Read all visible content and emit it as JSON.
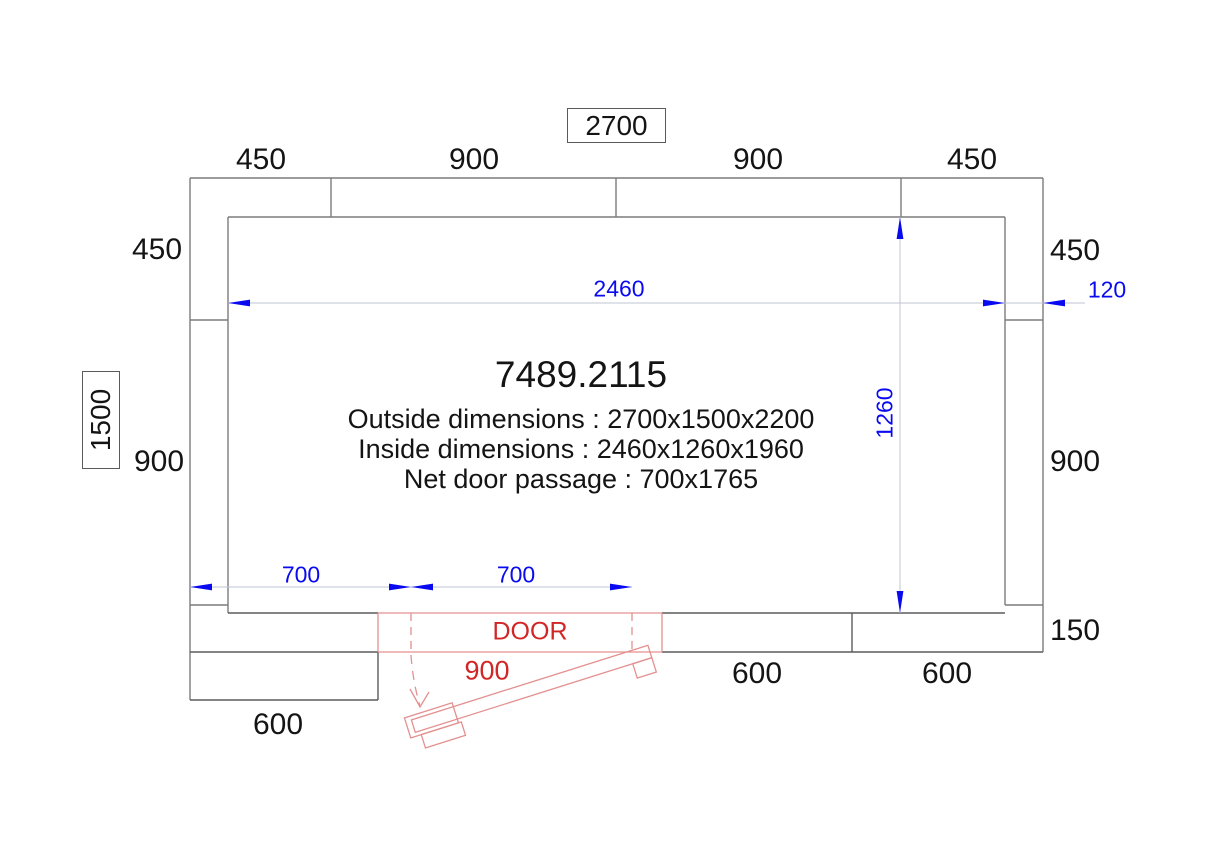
{
  "title_block": {
    "product_code": "7489.2115",
    "outside_dimensions": "Outside dimensions : 2700x1500x2200",
    "inside_dimensions": "Inside dimensions :  2460x1260x1960",
    "net_door_passage": "Net door passage : 700x1765"
  },
  "overall": {
    "width_label": "2700",
    "depth_label": "1500"
  },
  "top_segments": [
    "450",
    "900",
    "900",
    "450"
  ],
  "left_segments": [
    "450",
    "900"
  ],
  "right_segments": [
    "450",
    "900",
    "150"
  ],
  "bottom_segments": [
    "600",
    "600"
  ],
  "bottom_left_panel": "600",
  "inner": {
    "width": "2460",
    "depth": "1260",
    "wall_thickness": "120"
  },
  "door": {
    "label": "DOOR",
    "width": "900",
    "offset_left": "700",
    "passage": "700"
  },
  "colors": {
    "wall_line": "#7c7c7c",
    "panel_line": "#5c5c5c",
    "dimension_blue": "#0a0af0",
    "dimension_line": "#c2c6d6",
    "door_red_line": "#e39090",
    "door_red_text": "#d22626"
  }
}
